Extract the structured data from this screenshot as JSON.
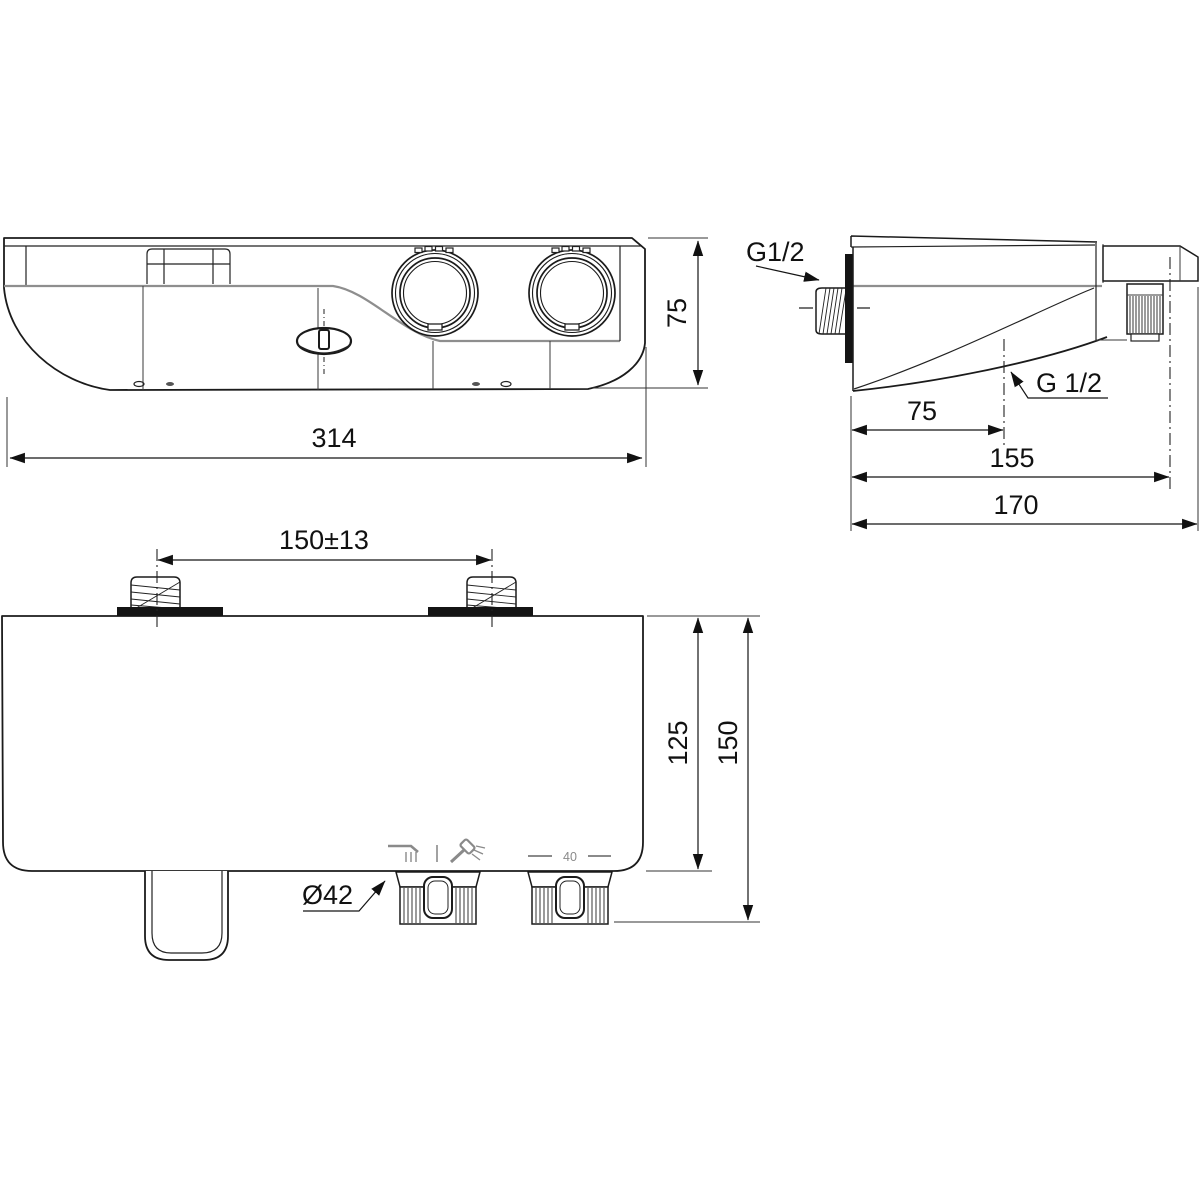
{
  "drawing": {
    "kind": "technical-dimensional-drawing",
    "colors": {
      "line": "#1b1b1b",
      "accent_gray": "#8e8e8e",
      "background": "#ffffff"
    },
    "dims": {
      "front_width": "314",
      "front_height": "75",
      "side_depth_inlet": "75",
      "side_depth_outlet": "155",
      "side_depth_total": "170",
      "inlet_thread": "G1/2",
      "outlet_thread": "G 1/2",
      "inlet_spacing": "150±13",
      "body_depth": "125",
      "total_depth": "150",
      "knob_diameter": "Ø42",
      "temp_mark": "40"
    },
    "icons": {
      "bath_spout": "bath-spout-icon",
      "hand_shower": "hand-shower-icon",
      "mode_divider": "mode-divider-icon"
    }
  }
}
